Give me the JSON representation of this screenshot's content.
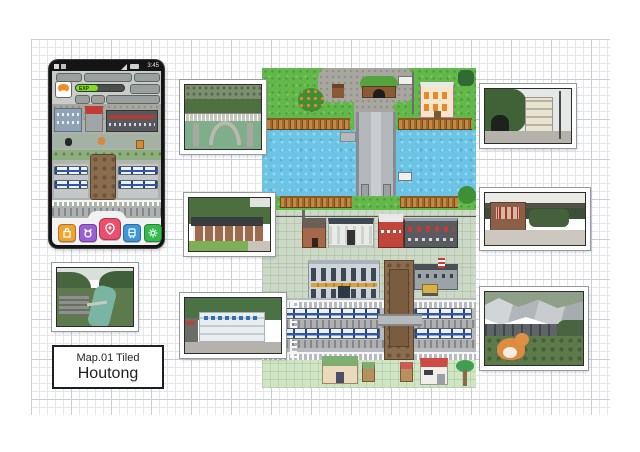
{
  "title_box": {
    "map_label": "Map.01 Tiled",
    "map_name": "Houtong"
  },
  "phone": {
    "status": {
      "time": "3:45"
    },
    "hud": {
      "exp_label": "EXP"
    },
    "nav_styles": [
      "background:#f0a330",
      "background:#9a5fd3",
      "background:#ef4d6e",
      "background:#3e97d8",
      "background:#36b94e"
    ]
  },
  "icons": {
    "phone_status": [
      "message-icon",
      "sim-icon",
      "signal-icon",
      "battery-icon"
    ],
    "phone_nav": [
      "bag-icon",
      "cat-icon",
      "paw-pin-icon",
      "train-icon",
      "gear-icon"
    ]
  },
  "colors": {
    "grass": "#63b84c",
    "stone_path": "#a7a79f",
    "river": "#6cc3e4",
    "wood_fence": "#b5762f",
    "train_blue": "#2f57a8",
    "plaza": "#ccd9c6",
    "pavement": "#cfe5c3",
    "ruin_brown": "#8a6c4e",
    "exp_green": "#7fdc1f",
    "nav_orange": "#f0a330",
    "nav_purple": "#9a5fd3",
    "nav_pink": "#ef4d6e",
    "nav_blue": "#3e97d8",
    "nav_green": "#36b94e"
  }
}
